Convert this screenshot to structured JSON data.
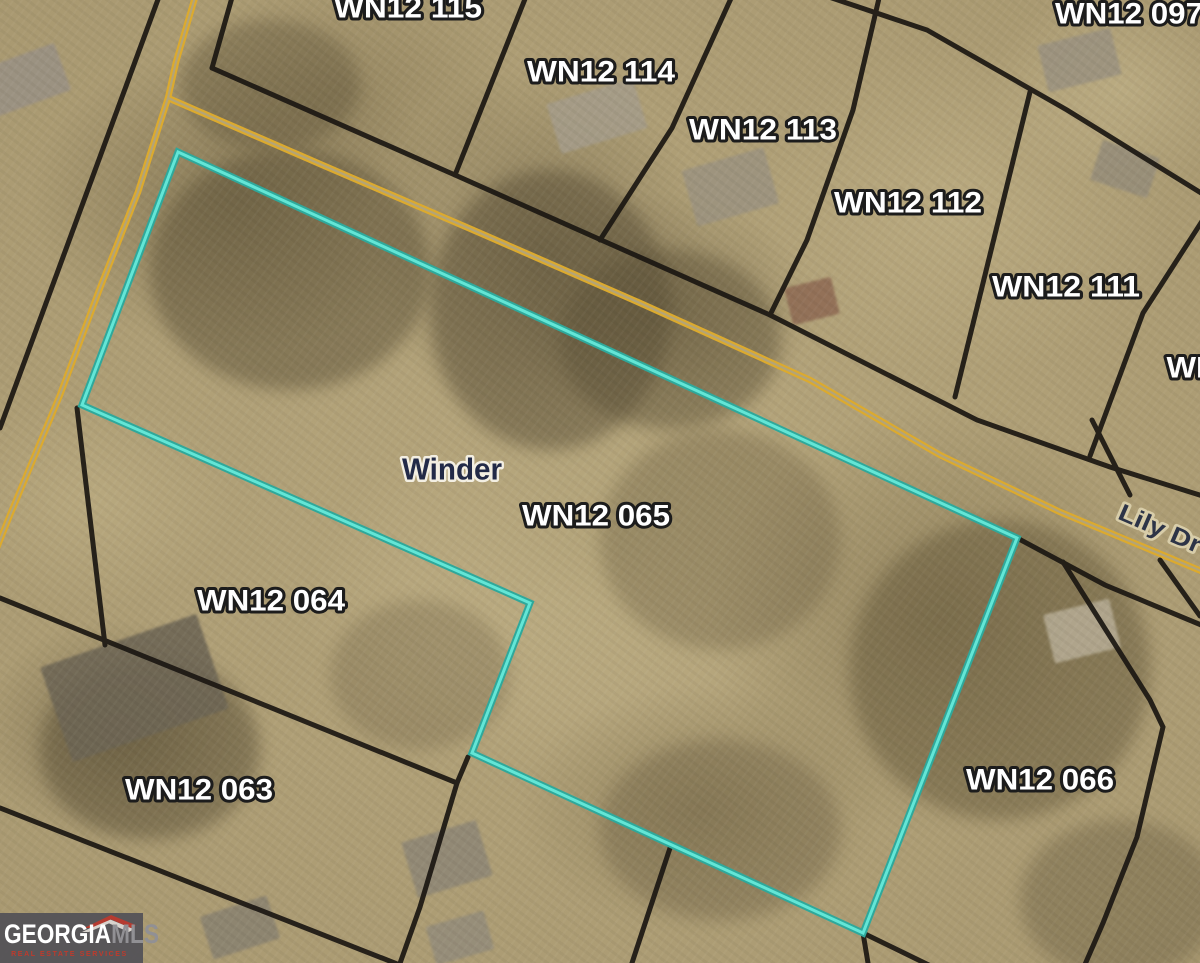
{
  "map": {
    "type": "aerial-parcel-map",
    "city_label": "Winder",
    "road_label": "Lily Dr",
    "highlighted_parcel_id": "WN12 065",
    "parcel_labels": [
      {
        "text": "WN12 115"
      },
      {
        "text": "WN12 114"
      },
      {
        "text": "WN12 113"
      },
      {
        "text": "WN12 112"
      },
      {
        "text": "WN12 111"
      },
      {
        "text": "WN12 097"
      },
      {
        "text": "WN12 065"
      },
      {
        "text": "WN12 064"
      },
      {
        "text": "WN12 063"
      },
      {
        "text": "WN12 066"
      },
      {
        "text": "WN12"
      }
    ]
  },
  "watermark": {
    "brand_primary": "GEORGIA",
    "brand_secondary": "MLS",
    "tagline": "REAL ESTATE SERVICES"
  },
  "colors": {
    "highlight_outline": "#2fa89b",
    "highlight_core": "#63e6d6",
    "road_yellow": "#dcaa2e",
    "road_gap": "#b3a478",
    "parcel_line": "#1b1712",
    "parcel_label_fill": "#ffffff",
    "parcel_label_outline": "#1c1c1c",
    "city_label_fill": "#222a47",
    "city_label_outline": "#f3efe2",
    "road_label_fill": "#2d3447",
    "road_label_outline": "#d8cda9",
    "watermark_background": "#57555a",
    "watermark_accent": "#b63b30"
  }
}
